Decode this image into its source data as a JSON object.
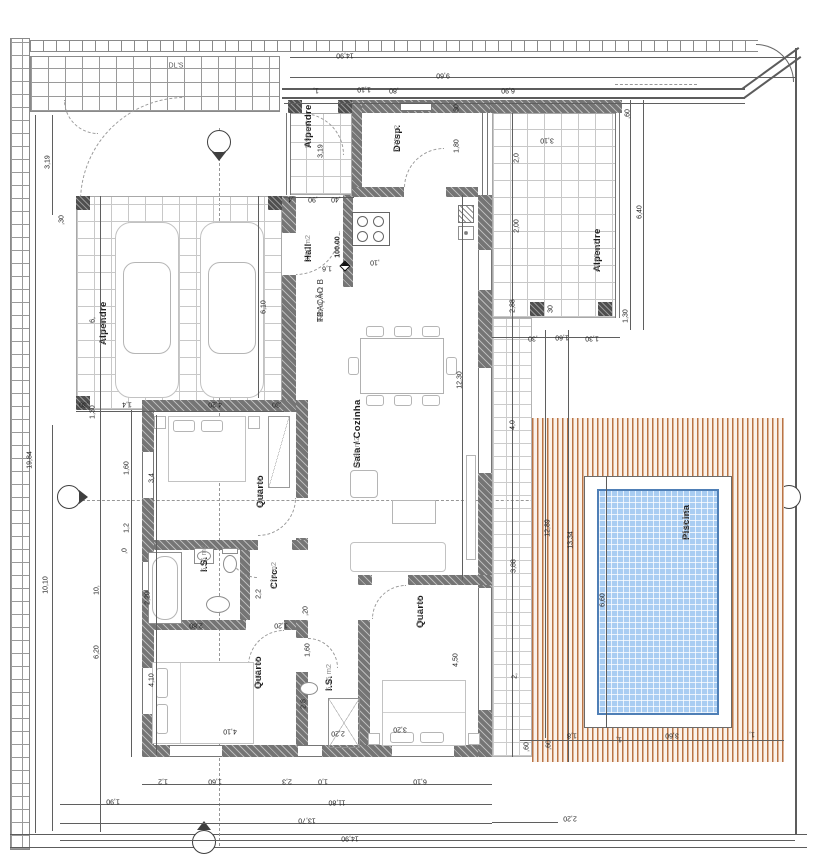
{
  "drawing": {
    "type": "architectural floor plan",
    "unit_hint": "m2",
    "gate_label": "DL'S",
    "level_marker": "100.00"
  },
  "fraction": {
    "line1": "T3",
    "line2": "FRAÇÃO B",
    "line3": "244,40 m2"
  },
  "colors": {
    "wall": "#757575",
    "deck_stripe": "#ae5e28",
    "pool_water": "#a9cdf2",
    "tile_grid": "#c8c8c8",
    "dimension_text": "#222222"
  },
  "rooms": [
    {
      "id": "alpendre-carport",
      "name": "Alpendre",
      "area": "38,00 m2",
      "x": 98,
      "y": 345
    },
    {
      "id": "alpendre-entry",
      "name": "Alpendre",
      "area": "5,90 m2",
      "x": 303,
      "y": 148
    },
    {
      "id": "desp",
      "name": "Desp.",
      "area": "6,75 m2",
      "x": 392,
      "y": 152
    },
    {
      "id": "hall",
      "name": "Hall",
      "area": "3,60 m2",
      "x": 303,
      "y": 262
    },
    {
      "id": "sala-cozinha",
      "name": "Sala / Cozinha",
      "area": "62,80 m2",
      "x": 352,
      "y": 468
    },
    {
      "id": "quarto-1",
      "name": "Quarto",
      "area": "14,80 m2",
      "x": 255,
      "y": 508
    },
    {
      "id": "is-1",
      "name": "I.S.",
      "area": "6,15 m2",
      "x": 199,
      "y": 572
    },
    {
      "id": "circ",
      "name": "Circ.",
      "area": "2,70 m2",
      "x": 269,
      "y": 589
    },
    {
      "id": "quarto-2",
      "name": "Quarto",
      "area": "16,05 m2",
      "x": 253,
      "y": 689
    },
    {
      "id": "is-2",
      "name": "I.S.",
      "area": "6,15 m2",
      "x": 324,
      "y": 691
    },
    {
      "id": "quarto-3",
      "name": "Quarto",
      "area": "19,15 m2",
      "x": 415,
      "y": 628
    },
    {
      "id": "alpendre-right",
      "name": "Alpendre",
      "area": "40,95 m2",
      "x": 592,
      "y": 272
    },
    {
      "id": "piscina",
      "name": "Piscina",
      "area": "23,80 m2",
      "x": 681,
      "y": 540
    }
  ],
  "dimensions": [
    {
      "t": "19,84",
      "x": 30,
      "y": 460,
      "r": 90
    },
    {
      "t": "3,19",
      "x": 48,
      "y": 162,
      "r": 90
    },
    {
      "t": ",30",
      "x": 62,
      "y": 220,
      "r": 90
    },
    {
      "t": "6,",
      "x": 93,
      "y": 320,
      "r": 90
    },
    {
      "t": "1,30",
      "x": 93,
      "y": 412,
      "r": 90
    },
    {
      "t": "10,10",
      "x": 46,
      "y": 585,
      "r": 90
    },
    {
      "t": "10,",
      "x": 97,
      "y": 590,
      "r": 90
    },
    {
      "t": "6,20",
      "x": 97,
      "y": 652,
      "r": 90
    },
    {
      "t": "1,60",
      "x": 127,
      "y": 468,
      "r": 90
    },
    {
      "t": "1,2",
      "x": 127,
      "y": 528,
      "r": 90
    },
    {
      "t": ",0",
      "x": 125,
      "y": 551,
      "r": 90
    },
    {
      "t": "3,4",
      "x": 152,
      "y": 478,
      "r": 90
    },
    {
      "t": "2,20",
      "x": 148,
      "y": 598,
      "r": 90
    },
    {
      "t": "4,10",
      "x": 152,
      "y": 680,
      "r": 90
    },
    {
      "t": "14,90",
      "x": 345,
      "y": 55,
      "r": 180
    },
    {
      "t": "9,60",
      "x": 443,
      "y": 75,
      "r": 180
    },
    {
      "t": "1,",
      "x": 316,
      "y": 90,
      "r": 180
    },
    {
      "t": "1,10",
      "x": 364,
      "y": 89,
      "r": 180
    },
    {
      "t": ",80",
      "x": 394,
      "y": 90,
      "r": 180
    },
    {
      "t": "6,90",
      "x": 508,
      "y": 90,
      "r": 180
    },
    {
      "t": ",60",
      "x": 628,
      "y": 114,
      "r": 90
    },
    {
      "t": "3,10",
      "x": 547,
      "y": 140,
      "r": 180
    },
    {
      "t": "2,0",
      "x": 517,
      "y": 158,
      "r": 90
    },
    {
      "t": "2,00",
      "x": 517,
      "y": 226,
      "r": 90
    },
    {
      "t": "2,88",
      "x": 513,
      "y": 306,
      "r": 90
    },
    {
      "t": "6,40",
      "x": 640,
      "y": 212,
      "r": 90
    },
    {
      "t": "1,30",
      "x": 626,
      "y": 316,
      "r": 90
    },
    {
      "t": "30",
      "x": 551,
      "y": 309,
      "r": 90
    },
    {
      "t": "1,80",
      "x": 457,
      "y": 146,
      "r": 90
    },
    {
      "t": "30",
      "x": 457,
      "y": 108,
      "r": 90
    },
    {
      "t": "6,10",
      "x": 264,
      "y": 307,
      "r": 90
    },
    {
      "t": "4,20",
      "x": 215,
      "y": 404,
      "r": 180
    },
    {
      "t": "1,4",
      "x": 127,
      "y": 404,
      "r": 180
    },
    {
      "t": ",30",
      "x": 84,
      "y": 404,
      "r": 180
    },
    {
      "t": ",30",
      "x": 277,
      "y": 404,
      "r": 180
    },
    {
      "t": ",4",
      "x": 291,
      "y": 199,
      "r": 180
    },
    {
      "t": ",90",
      "x": 313,
      "y": 199,
      "r": 180
    },
    {
      "t": ",40",
      "x": 336,
      "y": 199,
      "r": 180
    },
    {
      "t": "3,19",
      "x": 321,
      "y": 151,
      "r": 90
    },
    {
      "t": "1,6",
      "x": 327,
      "y": 268,
      "r": 180
    },
    {
      "t": ",10",
      "x": 375,
      "y": 262,
      "r": 180
    },
    {
      "t": "12,30",
      "x": 460,
      "y": 380,
      "r": 90
    },
    {
      "t": "4,0",
      "x": 513,
      "y": 425,
      "r": 90
    },
    {
      "t": "3,88",
      "x": 514,
      "y": 566,
      "r": 90
    },
    {
      "t": "2,",
      "x": 515,
      "y": 676,
      "r": 90
    },
    {
      "t": "12,89",
      "x": 548,
      "y": 528,
      "r": 90
    },
    {
      "t": "13,34",
      "x": 571,
      "y": 540,
      "r": 90
    },
    {
      "t": ",30",
      "x": 533,
      "y": 338,
      "r": 180
    },
    {
      "t": "1,60",
      "x": 562,
      "y": 337,
      "r": 180
    },
    {
      "t": "1,30",
      "x": 592,
      "y": 338,
      "r": 180
    },
    {
      "t": "2,2",
      "x": 259,
      "y": 594,
      "r": 90
    },
    {
      "t": ",20",
      "x": 306,
      "y": 611,
      "r": 90
    },
    {
      "t": "2,80",
      "x": 196,
      "y": 625,
      "r": 180
    },
    {
      "t": "1,20",
      "x": 281,
      "y": 625,
      "r": 180
    },
    {
      "t": "1,60",
      "x": 308,
      "y": 650,
      "r": 90
    },
    {
      "t": "2,8",
      "x": 304,
      "y": 704,
      "r": 90
    },
    {
      "t": "4,10",
      "x": 230,
      "y": 731,
      "r": 180
    },
    {
      "t": "2,20",
      "x": 338,
      "y": 733,
      "r": 180
    },
    {
      "t": "4,50",
      "x": 456,
      "y": 660,
      "r": 90
    },
    {
      "t": "3,20",
      "x": 400,
      "y": 729,
      "r": 180
    },
    {
      "t": "1,2",
      "x": 163,
      "y": 781,
      "r": 180
    },
    {
      "t": "1,60",
      "x": 215,
      "y": 781,
      "r": 180
    },
    {
      "t": "2,3",
      "x": 287,
      "y": 781,
      "r": 180
    },
    {
      "t": "1,0",
      "x": 323,
      "y": 781,
      "r": 180
    },
    {
      "t": "6,10",
      "x": 420,
      "y": 781,
      "r": 180
    },
    {
      "t": "1,90",
      "x": 113,
      "y": 801,
      "r": 180
    },
    {
      "t": "11,80",
      "x": 337,
      "y": 802,
      "r": 180
    },
    {
      "t": "13,70",
      "x": 307,
      "y": 820,
      "r": 180
    },
    {
      "t": "14,90",
      "x": 350,
      "y": 838,
      "r": 180
    },
    {
      "t": "2,20",
      "x": 570,
      "y": 818,
      "r": 180
    },
    {
      "t": ",60",
      "x": 527,
      "y": 747,
      "r": 90
    },
    {
      "t": ",60",
      "x": 549,
      "y": 745,
      "r": 90
    },
    {
      "t": "1,8",
      "x": 572,
      "y": 735,
      "r": 180
    },
    {
      "t": "1,",
      "x": 619,
      "y": 739,
      "r": 180
    },
    {
      "t": "3,60",
      "x": 672,
      "y": 735,
      "r": 180
    },
    {
      "t": "1,",
      "x": 752,
      "y": 734,
      "r": 180
    },
    {
      "t": "6,60",
      "x": 603,
      "y": 600,
      "r": 90
    }
  ]
}
